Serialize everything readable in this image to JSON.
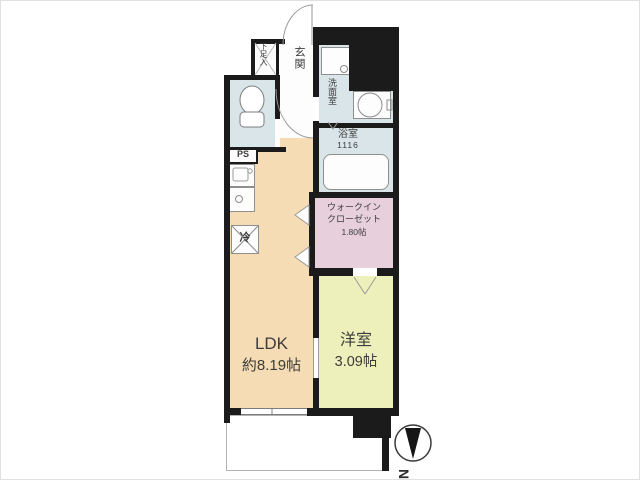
{
  "plan_type": "apartment-floorplan",
  "rooms": {
    "ldk": {
      "name": "LDK",
      "size": "約8.19帖"
    },
    "western_room": {
      "name": "洋室",
      "size": "3.09帖"
    },
    "walk_in_closet": {
      "name_line1": "ウォークイン",
      "name_line2": "クローゼット",
      "size": "1.80帖"
    },
    "bathroom": {
      "name": "浴室",
      "size": "1116"
    },
    "washroom": {
      "name": "洗面室"
    },
    "entrance": {
      "name": "玄関"
    },
    "shoe_cabinet": {
      "name": "下足入"
    }
  },
  "fixtures": {
    "pipe_space": "PS",
    "refrigerator": "冷"
  },
  "compass": {
    "north_label": "N"
  },
  "colors": {
    "wall": "#1b1b1b",
    "ldk": "#f6dcb4",
    "western_room": "#eef0bb",
    "walk_in_closet": "#e7cfdc",
    "wet_area": "#d9e5e9",
    "background": "#ffffff"
  }
}
